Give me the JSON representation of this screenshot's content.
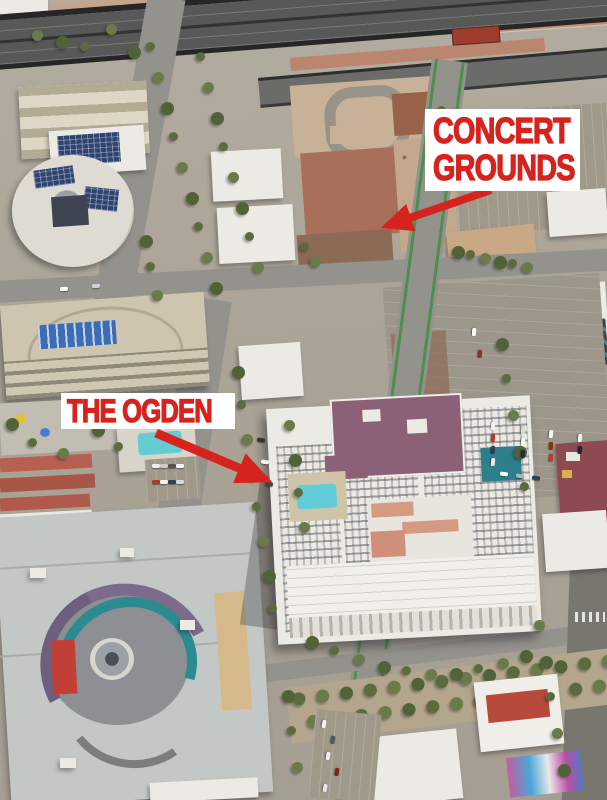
{
  "annotations": {
    "concert_grounds": {
      "line1": "CONCERT",
      "line2": "GROUNDS"
    },
    "the_ogden": {
      "label": "THE OGDEN"
    }
  },
  "colors": {
    "annotation-red": "#d7231e",
    "annotation-bg": "#ffffff"
  }
}
